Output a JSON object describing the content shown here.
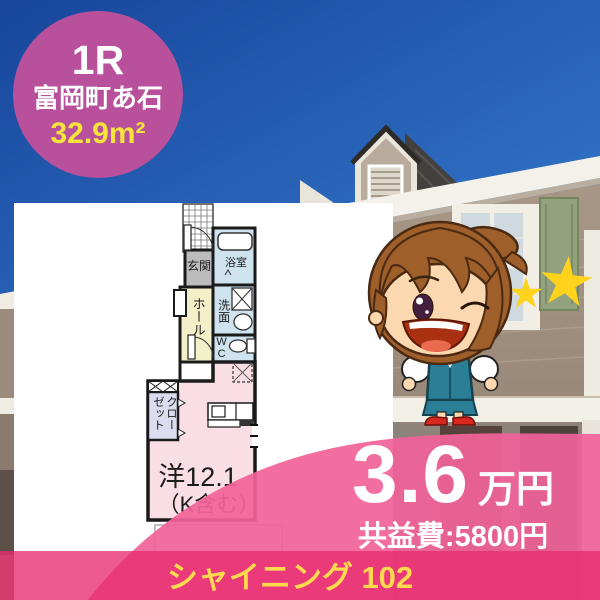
{
  "badge": {
    "layout_type": "1R",
    "location": "富岡町あ石",
    "area": "32.9m²"
  },
  "floor_plan": {
    "entrance": "玄関",
    "bathroom": "浴室",
    "washroom": "洗面",
    "toilet": "WC",
    "hall": "ホール",
    "closet": "クローゼット",
    "main_room_line1": "洋12.1",
    "main_room_line2": "（K含む）",
    "balcony": "バルコニー"
  },
  "price": {
    "rent_amount": "3.6",
    "rent_unit": "万円",
    "common_fee": "共益費:5800円"
  },
  "property": {
    "name_and_unit": "シャイニング 102"
  },
  "icons": {
    "mascot": "real-estate-agent-mascot",
    "star": "rating-star"
  },
  "colors": {
    "badge_pink": "#b8509c",
    "ribbon_pink": "#f1639b",
    "strip_pink": "#e82c6e",
    "highlight_yellow": "#f6e33c",
    "star_yellow": "#ffd21c"
  }
}
